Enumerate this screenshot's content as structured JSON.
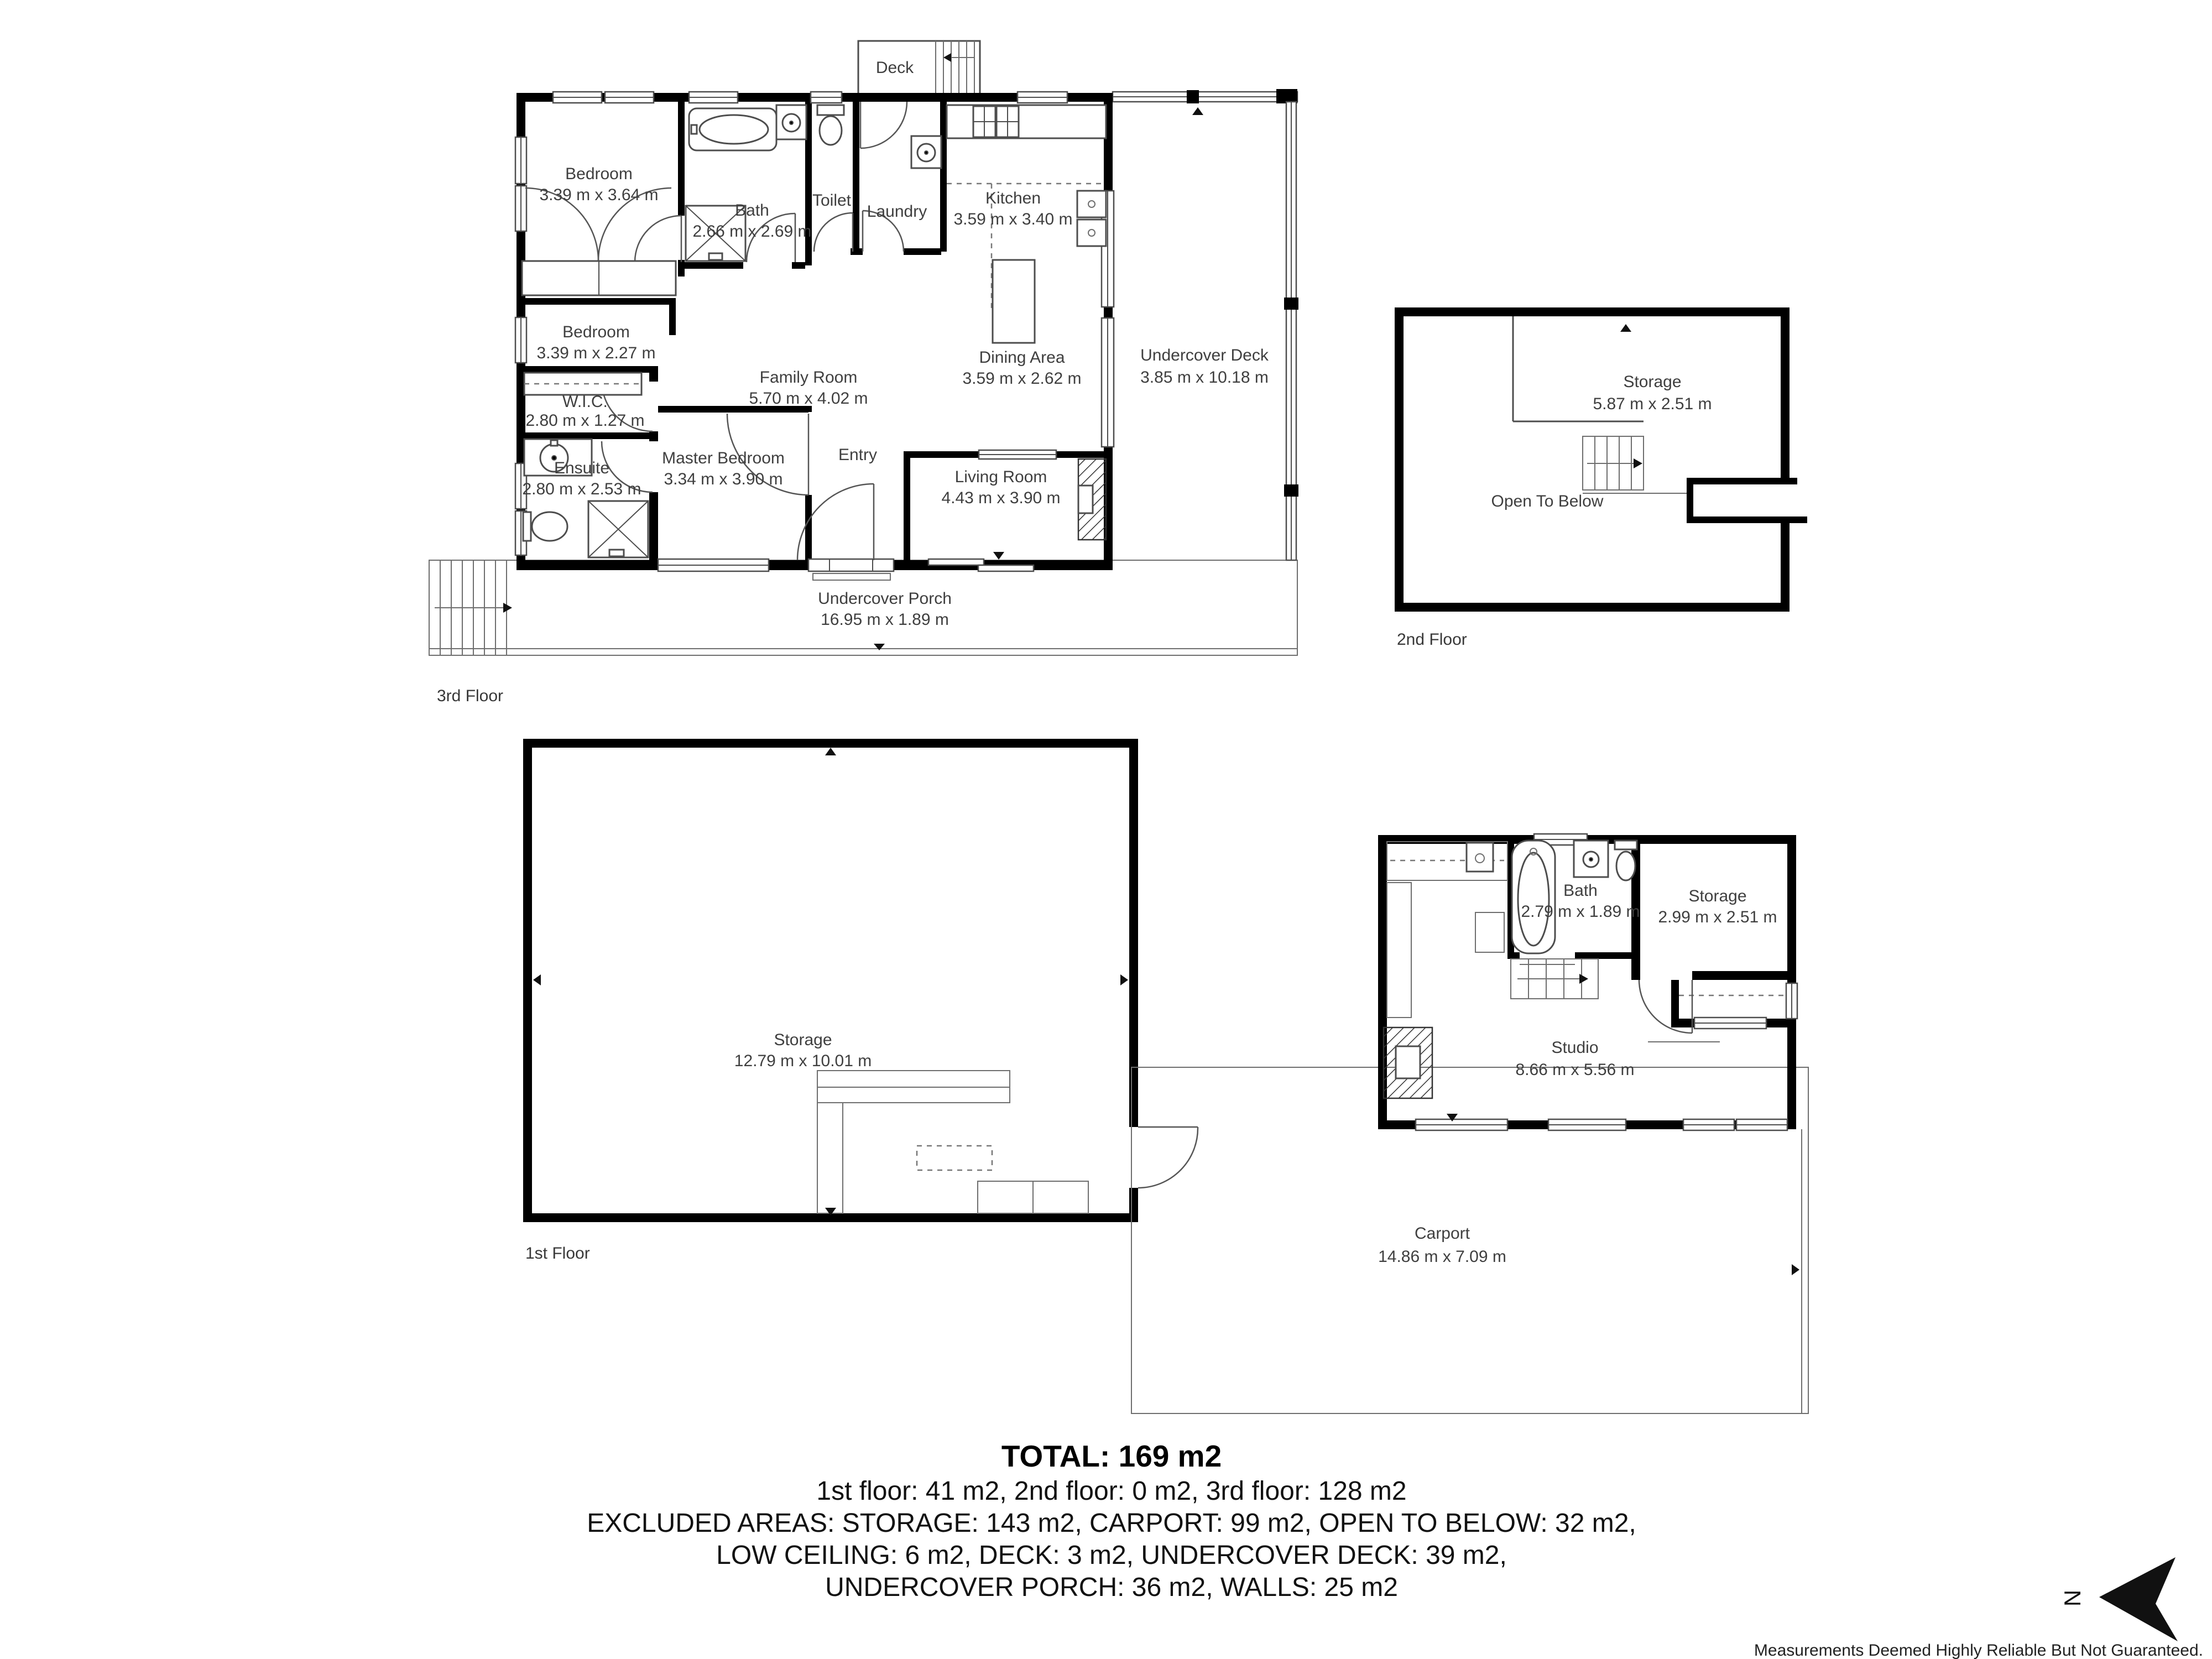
{
  "colors": {
    "wall": "#000000",
    "line": "#4d4d4d",
    "label": "#3f3f3f",
    "text": "#111111"
  },
  "floor3": {
    "floor_label": "3rd Floor",
    "rooms": {
      "bedroom1": {
        "name": "Bedroom",
        "dims": "3.39 m x 3.64 m"
      },
      "bath": {
        "name": "Bath",
        "dims": "2.66 m x 2.69 m"
      },
      "toilet": {
        "name": "Toilet"
      },
      "laundry": {
        "name": "Laundry"
      },
      "kitchen": {
        "name": "Kitchen",
        "dims": "3.59 m x 3.40 m"
      },
      "family_room": {
        "name": "Family Room",
        "dims": "5.70 m x 4.02 m"
      },
      "dining_area": {
        "name": "Dining Area",
        "dims": "3.59 m x 2.62 m"
      },
      "bedroom2": {
        "name": "Bedroom",
        "dims": "3.39 m x 2.27 m"
      },
      "wic": {
        "name": "W.I.C.",
        "dims": "2.80 m x 1.27 m"
      },
      "ensuite": {
        "name": "Ensuite",
        "dims": "2.80 m x 2.53 m"
      },
      "master_bedroom": {
        "name": "Master Bedroom",
        "dims": "3.34 m x 3.90 m"
      },
      "entry": {
        "name": "Entry"
      },
      "living_room": {
        "name": "Living Room",
        "dims": "4.43 m x 3.90 m"
      },
      "undercover_deck": {
        "name": "Undercover Deck",
        "dims": "3.85 m x 10.18 m"
      },
      "undercover_porch": {
        "name": "Undercover Porch",
        "dims": "16.95 m x 1.89 m"
      },
      "deck": {
        "name": "Deck"
      }
    }
  },
  "floor2": {
    "floor_label": "2nd Floor",
    "rooms": {
      "storage": {
        "name": "Storage",
        "dims": "5.87 m x 2.51 m"
      },
      "open_to_below": {
        "name": "Open To Below"
      }
    }
  },
  "floor1": {
    "floor_label": "1st Floor",
    "rooms": {
      "storage": {
        "name": "Storage",
        "dims": "12.79 m x 10.01 m"
      }
    }
  },
  "studio_building": {
    "rooms": {
      "bath": {
        "name": "Bath",
        "dims": "2.79 m x 1.89 m"
      },
      "storage": {
        "name": "Storage",
        "dims": "2.99 m x 2.51 m"
      },
      "studio": {
        "name": "Studio",
        "dims": "8.66 m x 5.56 m"
      },
      "carport": {
        "name": "Carport",
        "dims": "14.86 m x 7.09 m"
      }
    }
  },
  "summary": {
    "total": "TOTAL: 169 m2",
    "floors": "1st floor: 41 m2, 2nd floor: 0 m2, 3rd floor: 128 m2",
    "excluded1": "EXCLUDED AREAS: STORAGE: 143 m2, CARPORT: 99 m2, OPEN TO BELOW: 32 m2,",
    "excluded2": "LOW CEILING: 6 m2, DECK: 3 m2, UNDERCOVER DECK: 39 m2,",
    "excluded3": "UNDERCOVER PORCH: 36 m2, WALLS: 25 m2"
  },
  "footer": {
    "disclaimer": "Measurements Deemed Highly Reliable But Not Guaranteed."
  },
  "compass": {
    "north_label": "N"
  }
}
